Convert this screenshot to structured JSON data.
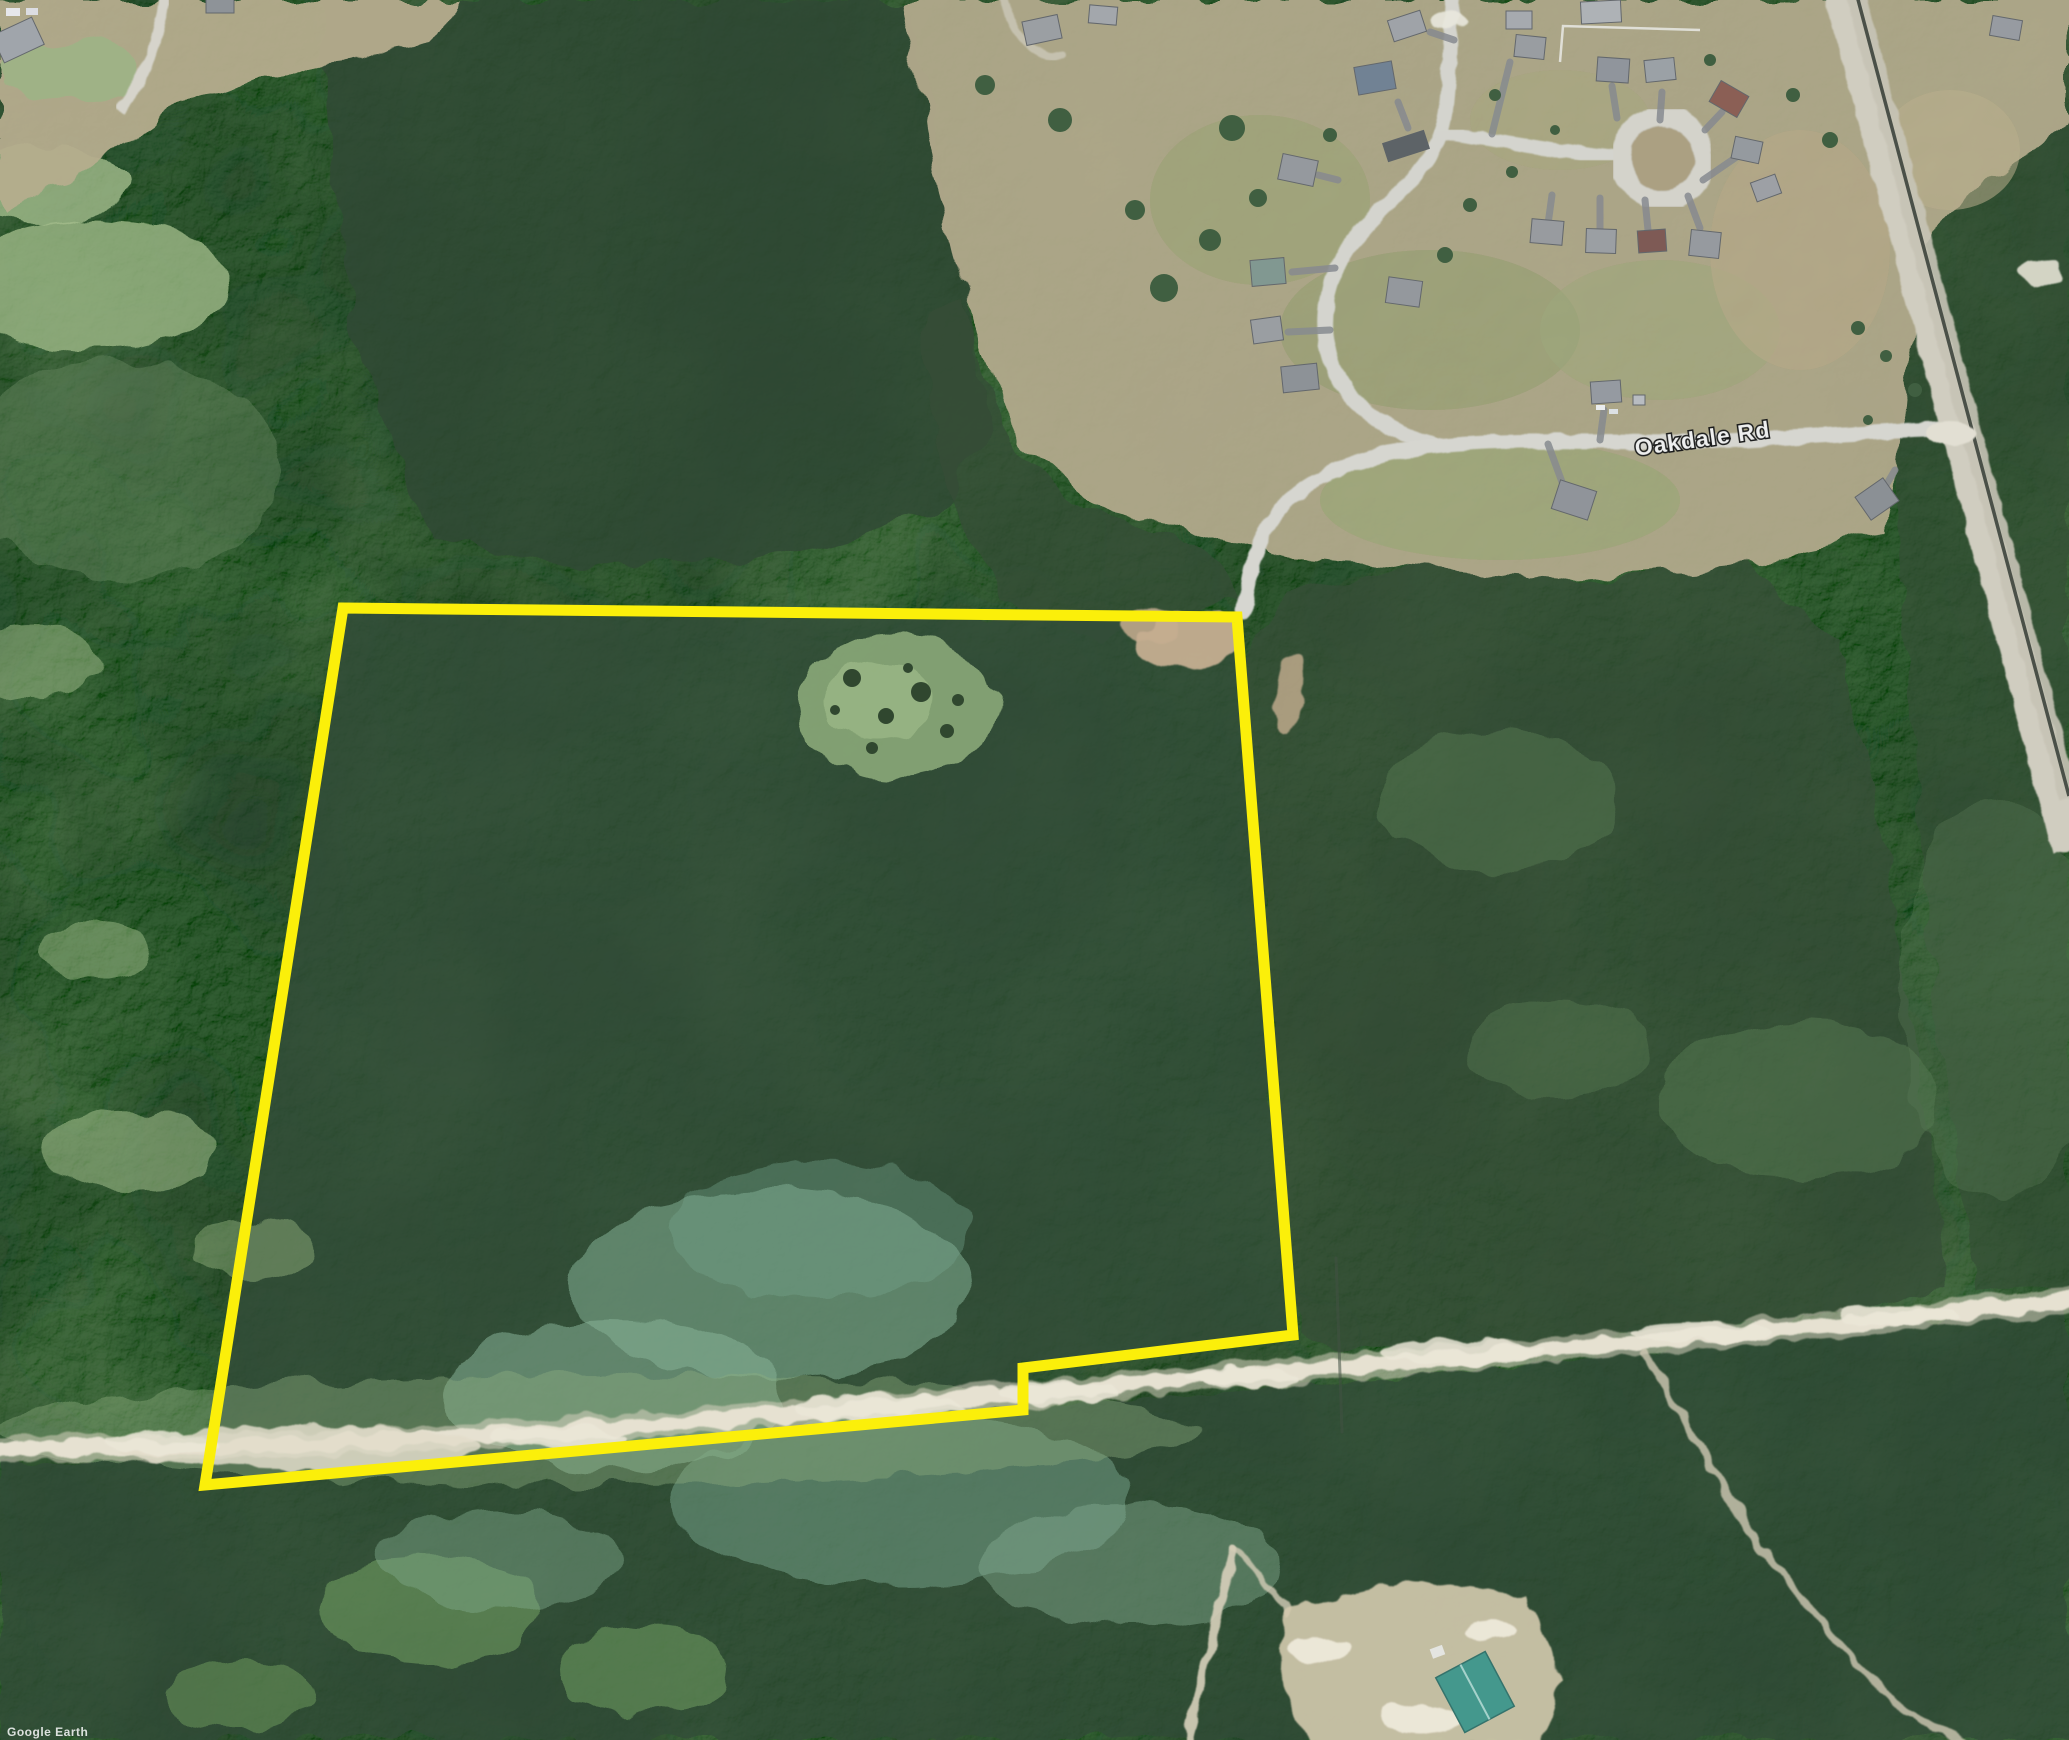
{
  "app": {
    "watermark": "Google Earth"
  },
  "map": {
    "type": "aerial-satellite-imagery",
    "road_label": "Oakdale Rd",
    "road_label_fill": "#f2f2f2",
    "road_label_halo": "#141414"
  },
  "boundary": {
    "description": "parcel-outline",
    "color": "#fff200",
    "stroke_width": 11,
    "points": "343,608 1237,617 1293,1335 1023,1368 1023,1410 205,1485"
  }
}
